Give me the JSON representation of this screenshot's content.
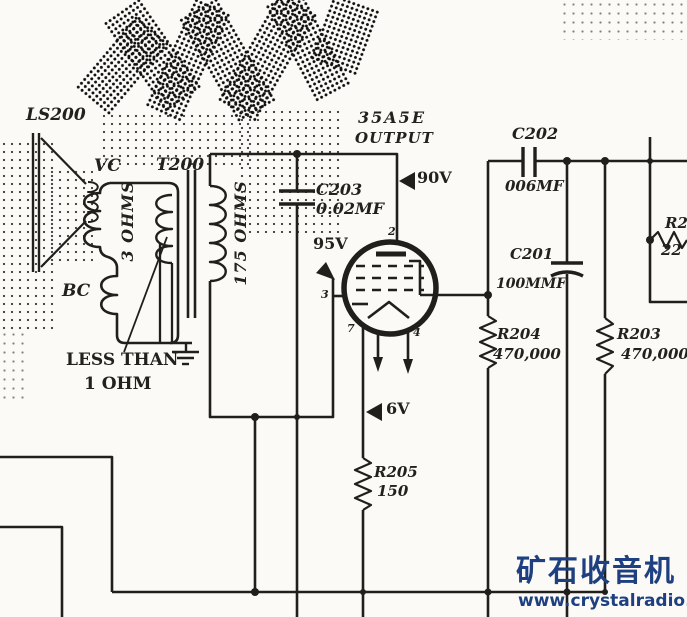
{
  "schematic": {
    "speaker": {
      "ref": "LS200",
      "terminal_vc": "VC",
      "terminal_bc": "BC",
      "vc_impedance": "3 OHMS",
      "note_line1": "LESS THAN",
      "note_line2": "1 OHM"
    },
    "transformer": {
      "ref": "T200",
      "winding_impedance": "175 OHMS"
    },
    "tube": {
      "type": "35A5E",
      "function": "OUTPUT",
      "pin_top": "2",
      "pin_left": "3",
      "pin_bottom_left": "7",
      "pin_bottom_right": "4"
    },
    "voltages": {
      "voltage_90": "90V",
      "voltage_95": "95V",
      "voltage_6": "6V"
    },
    "capacitors": {
      "c203": {
        "ref": "C203",
        "value": "0.02MF"
      },
      "c202": {
        "ref": "C202",
        "value": "006MF"
      },
      "c201": {
        "ref": "C201",
        "value": "100MMF"
      }
    },
    "resistors": {
      "r204": {
        "ref": "R204",
        "value": "470,000"
      },
      "r203": {
        "ref": "R203",
        "value": "470,000"
      },
      "r205": {
        "ref": "R205",
        "value": "150"
      },
      "r_edge": {
        "ref": "R2",
        "value": "22"
      }
    }
  },
  "watermark": {
    "site_name": "矿石收音机",
    "site_url": "www.crystalradio.cn",
    "color": "#1e4080"
  },
  "ink_color": "#201f1b"
}
